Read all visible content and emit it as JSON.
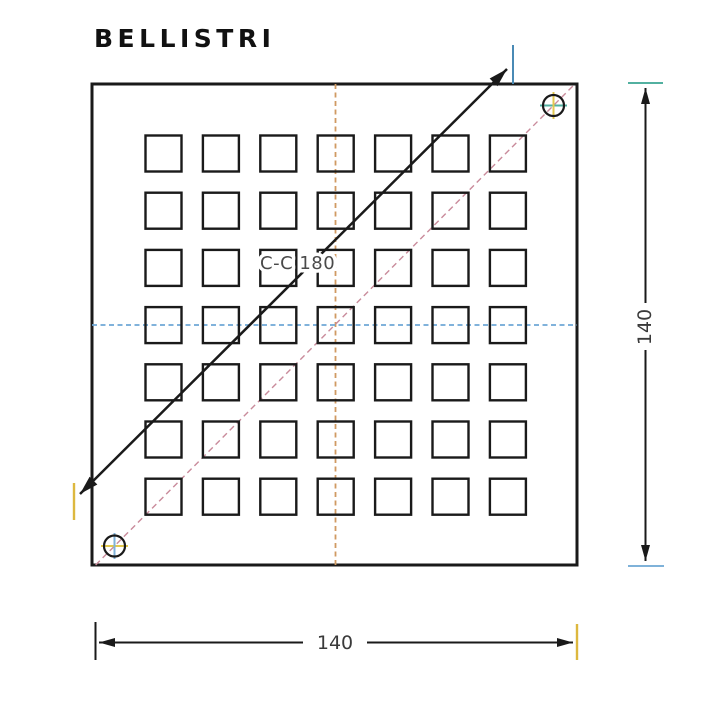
{
  "title": "BELLISTRI",
  "drawing": {
    "section": {
      "label": "C-C 180"
    },
    "dimensions": {
      "width": {
        "label": "140"
      },
      "height": {
        "label": "140"
      }
    },
    "grid": {
      "rows": 7,
      "cols": 7
    },
    "colors": {
      "line": "#1a1a1a",
      "dim_text": "#3a3a3a",
      "section_text": "#4a4a4a",
      "centerline_v": "#d09a62",
      "centerline_h": "#6fa8d6",
      "centerline_diag": "#c98b9b",
      "tick_steel_blue": "#4a8ab5",
      "tick_gold": "#ddb83f",
      "tick_teal": "#52b0a0",
      "tick_light_blue": "#7fb2d9",
      "cross_yellow": "#e3c94f"
    }
  }
}
